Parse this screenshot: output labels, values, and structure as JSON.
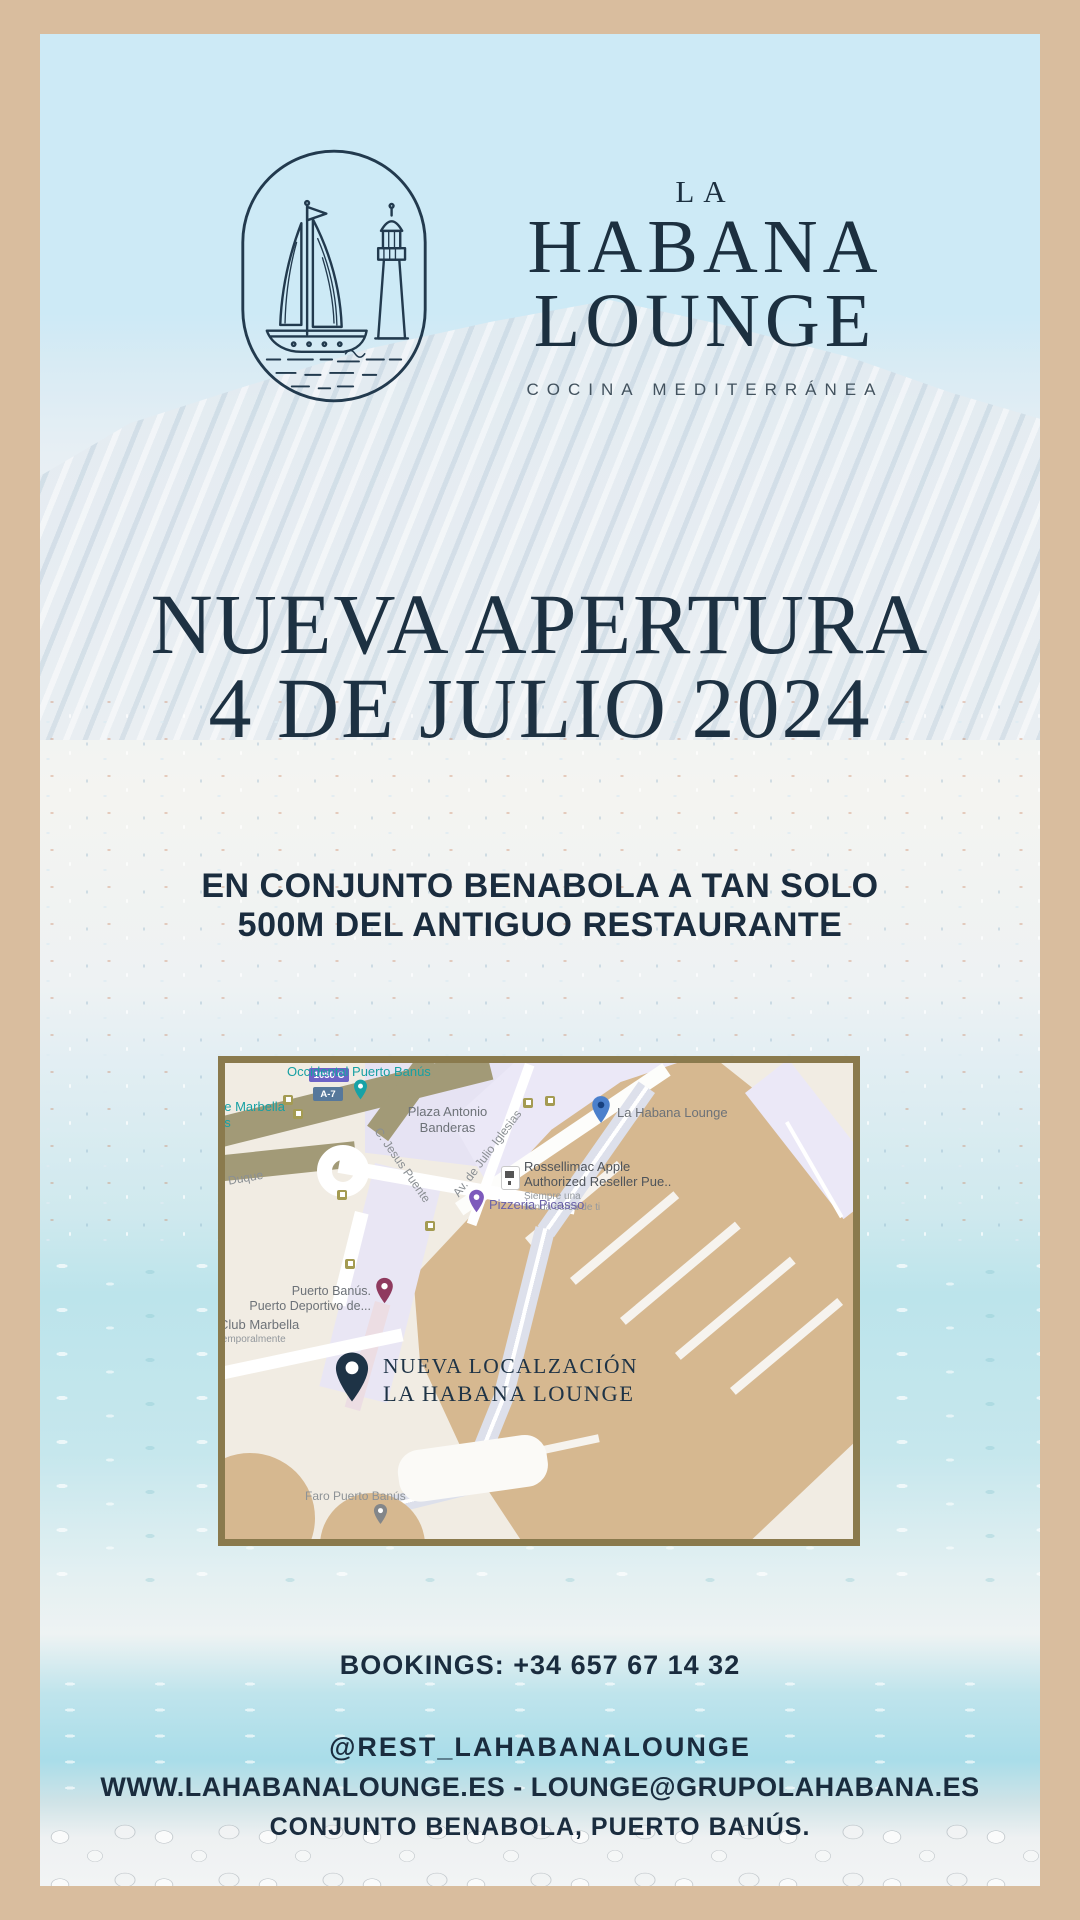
{
  "colors": {
    "frame_tan": "#d9bd9e",
    "navy_text": "#1c3040",
    "sky_blue": "#cdeaf6",
    "map_border_olive": "#8a7a4d",
    "dock_tan": "#d6b890",
    "teal_label": "#17a0a3",
    "saved_pin_blue": "#4b80cc"
  },
  "brand": {
    "overline": "LA",
    "name_line1": "HABANA",
    "name_line2": "LOUNGE",
    "tagline": "COCINA MEDITERRÁNEA"
  },
  "headline": {
    "line1": "NUEVA APERTURA",
    "line2": "4 DE JULIO 2024"
  },
  "subheadline": {
    "line1": "EN CONJUNTO BENABOLA A TAN SOLO",
    "line2": "500M DEL ANTIGUO RESTAURANTE"
  },
  "map": {
    "route_badge": "1050 C",
    "road_badge": "A-7",
    "labels": {
      "hotel": "Occidental Puerto Banús",
      "marbella_fragment1": "ge Marbella",
      "marbella_fragment2": "os",
      "plaza_line1": "Plaza Antonio",
      "plaza_line2": "Banderas",
      "street_jesus": "C. Jesus Puente",
      "street_julio": "Av. de Julio Iglesias",
      "street_duque": "l Duque",
      "habana_pin": "La Habana Lounge",
      "apple_line1": "Rossellimac Apple",
      "apple_line2": "Authorized Reseller Pue..",
      "apple_sub1": "Siempre una",
      "apple_sub2": "tienda cerca de ti",
      "pizzeria": "Pizzeria Picasso",
      "puerto_line1": "Puerto Banús.",
      "puerto_line2": "Puerto Deportivo de...",
      "club_line1": "Club Marbella",
      "club_line2": "temporalmente",
      "faro": "Faro Puerto Banús"
    },
    "callout": {
      "line1": "NUEVA LOCALZACIÓN",
      "line2": "LA HABANA LOUNGE"
    }
  },
  "footer": {
    "bookings": "BOOKINGS: +34 657 67 14 32",
    "instagram": "@REST_LAHABANALOUNGE",
    "web_email": "WWW.LAHABANALOUNGE.ES - LOUNGE@GRUPOLAHABANA.ES",
    "address": "CONJUNTO BENABOLA, PUERTO BANÚS."
  }
}
